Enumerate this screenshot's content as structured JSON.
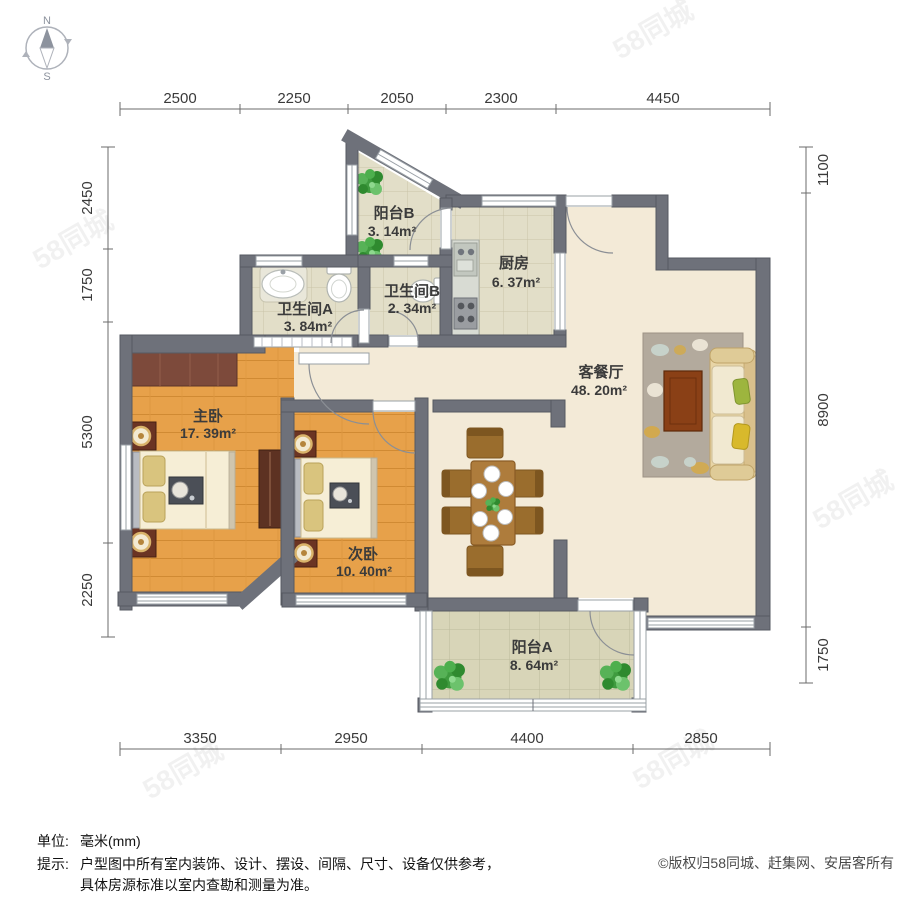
{
  "compass": {
    "north": "N",
    "south": "S"
  },
  "dimensions": {
    "top": [
      "2500",
      "2250",
      "2050",
      "2300",
      "4450"
    ],
    "bottom": [
      "3350",
      "2950",
      "4400",
      "2850"
    ],
    "left": [
      "2450",
      "1750",
      "5300",
      "2250"
    ],
    "right": [
      "1100",
      "8900",
      "1750"
    ]
  },
  "rooms": [
    {
      "name": "阳台B",
      "area": "3. 14m²"
    },
    {
      "name": "厨房",
      "area": "6. 37m²"
    },
    {
      "name": "卫生间A",
      "area": "3. 84m²"
    },
    {
      "name": "卫生间B",
      "area": "2. 34m²"
    },
    {
      "name": "客餐厅",
      "area": "48. 20m²"
    },
    {
      "name": "主卧",
      "area": "17. 39m²"
    },
    {
      "name": "次卧",
      "area": "10. 40m²"
    },
    {
      "name": "阳台A",
      "area": "8. 64m²"
    }
  ],
  "footer": {
    "unit_label": "单位:",
    "unit_value": "毫米(mm)",
    "tip_label": "提示:",
    "tip_line1": "户型图中所有室内装饰、设计、摆设、间隔、尺寸、设备仅供参考，",
    "tip_line2": "具体房源标准以室内查勘和测量为准。",
    "copyright": "©版权归58同城、赶集网、安居客所有"
  },
  "watermark": "58同城",
  "colors": {
    "wall": "#6e717a",
    "bedroom_floor": "#e7a14a",
    "living_floor": "#f3ead7",
    "tile_floor": "#e2dec8",
    "balcony_floor": "#d8d5b8"
  }
}
